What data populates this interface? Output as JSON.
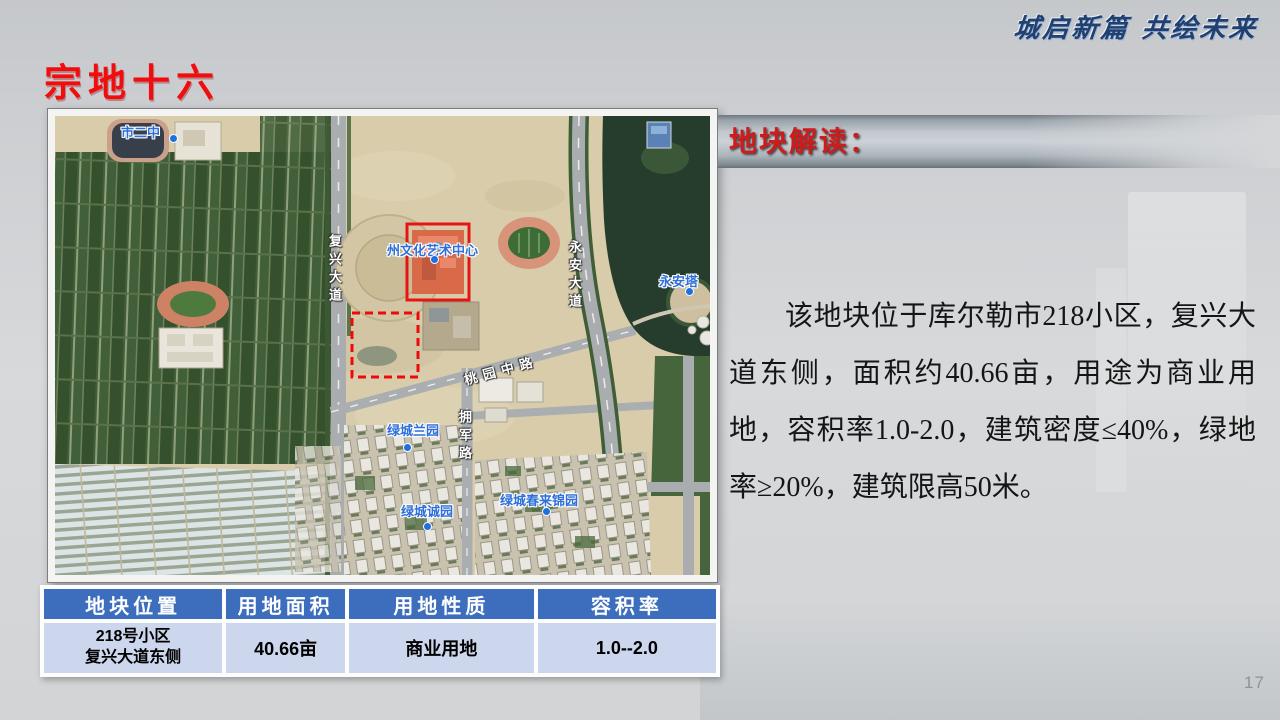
{
  "slide": {
    "motto": "城启新篇  共绘未来",
    "title": "宗地十六",
    "page_number": "17"
  },
  "analysis": {
    "header": "地块解读：",
    "body": "该地块位于库尔勒市218小区，复兴大道东侧，面积约40.66亩，用途为商业用地，容积率1.0-2.0，建筑密度≤40%，绿地率≥20%，建筑限高50米。"
  },
  "map": {
    "labels": {
      "school": "市二中",
      "art_center": "州文化艺术中心",
      "pagoda": "永安塔",
      "lanyuan": "绿城兰园",
      "chengyuan": "绿城诚园",
      "chunlai": "绿城春来锦园",
      "road_fuxing": "复兴大道",
      "road_yongan": "永安大道",
      "road_yongjun": "拥军路",
      "road_taoyuan": "桃园中路"
    },
    "parcel_marker": "red-dashed-rectangle"
  },
  "table": {
    "headers": [
      "地块位置",
      "用地面积",
      "用地性质",
      "容积率"
    ],
    "row": {
      "location_line1": "218号小区",
      "location_line2": "复兴大道东侧",
      "area": "40.66亩",
      "nature": "商业用地",
      "far": "1.0--2.0"
    }
  },
  "colors": {
    "title_red": "#f10d0d",
    "analysis_red": "#cf1b1b",
    "table_header_blue": "#3d6ebe",
    "table_row_blue": "#ccd6ec",
    "motto_navy": "#20406f",
    "parcel_outline_red": "#ee0a0a",
    "map_poi_blue": "#2e6fd9"
  }
}
